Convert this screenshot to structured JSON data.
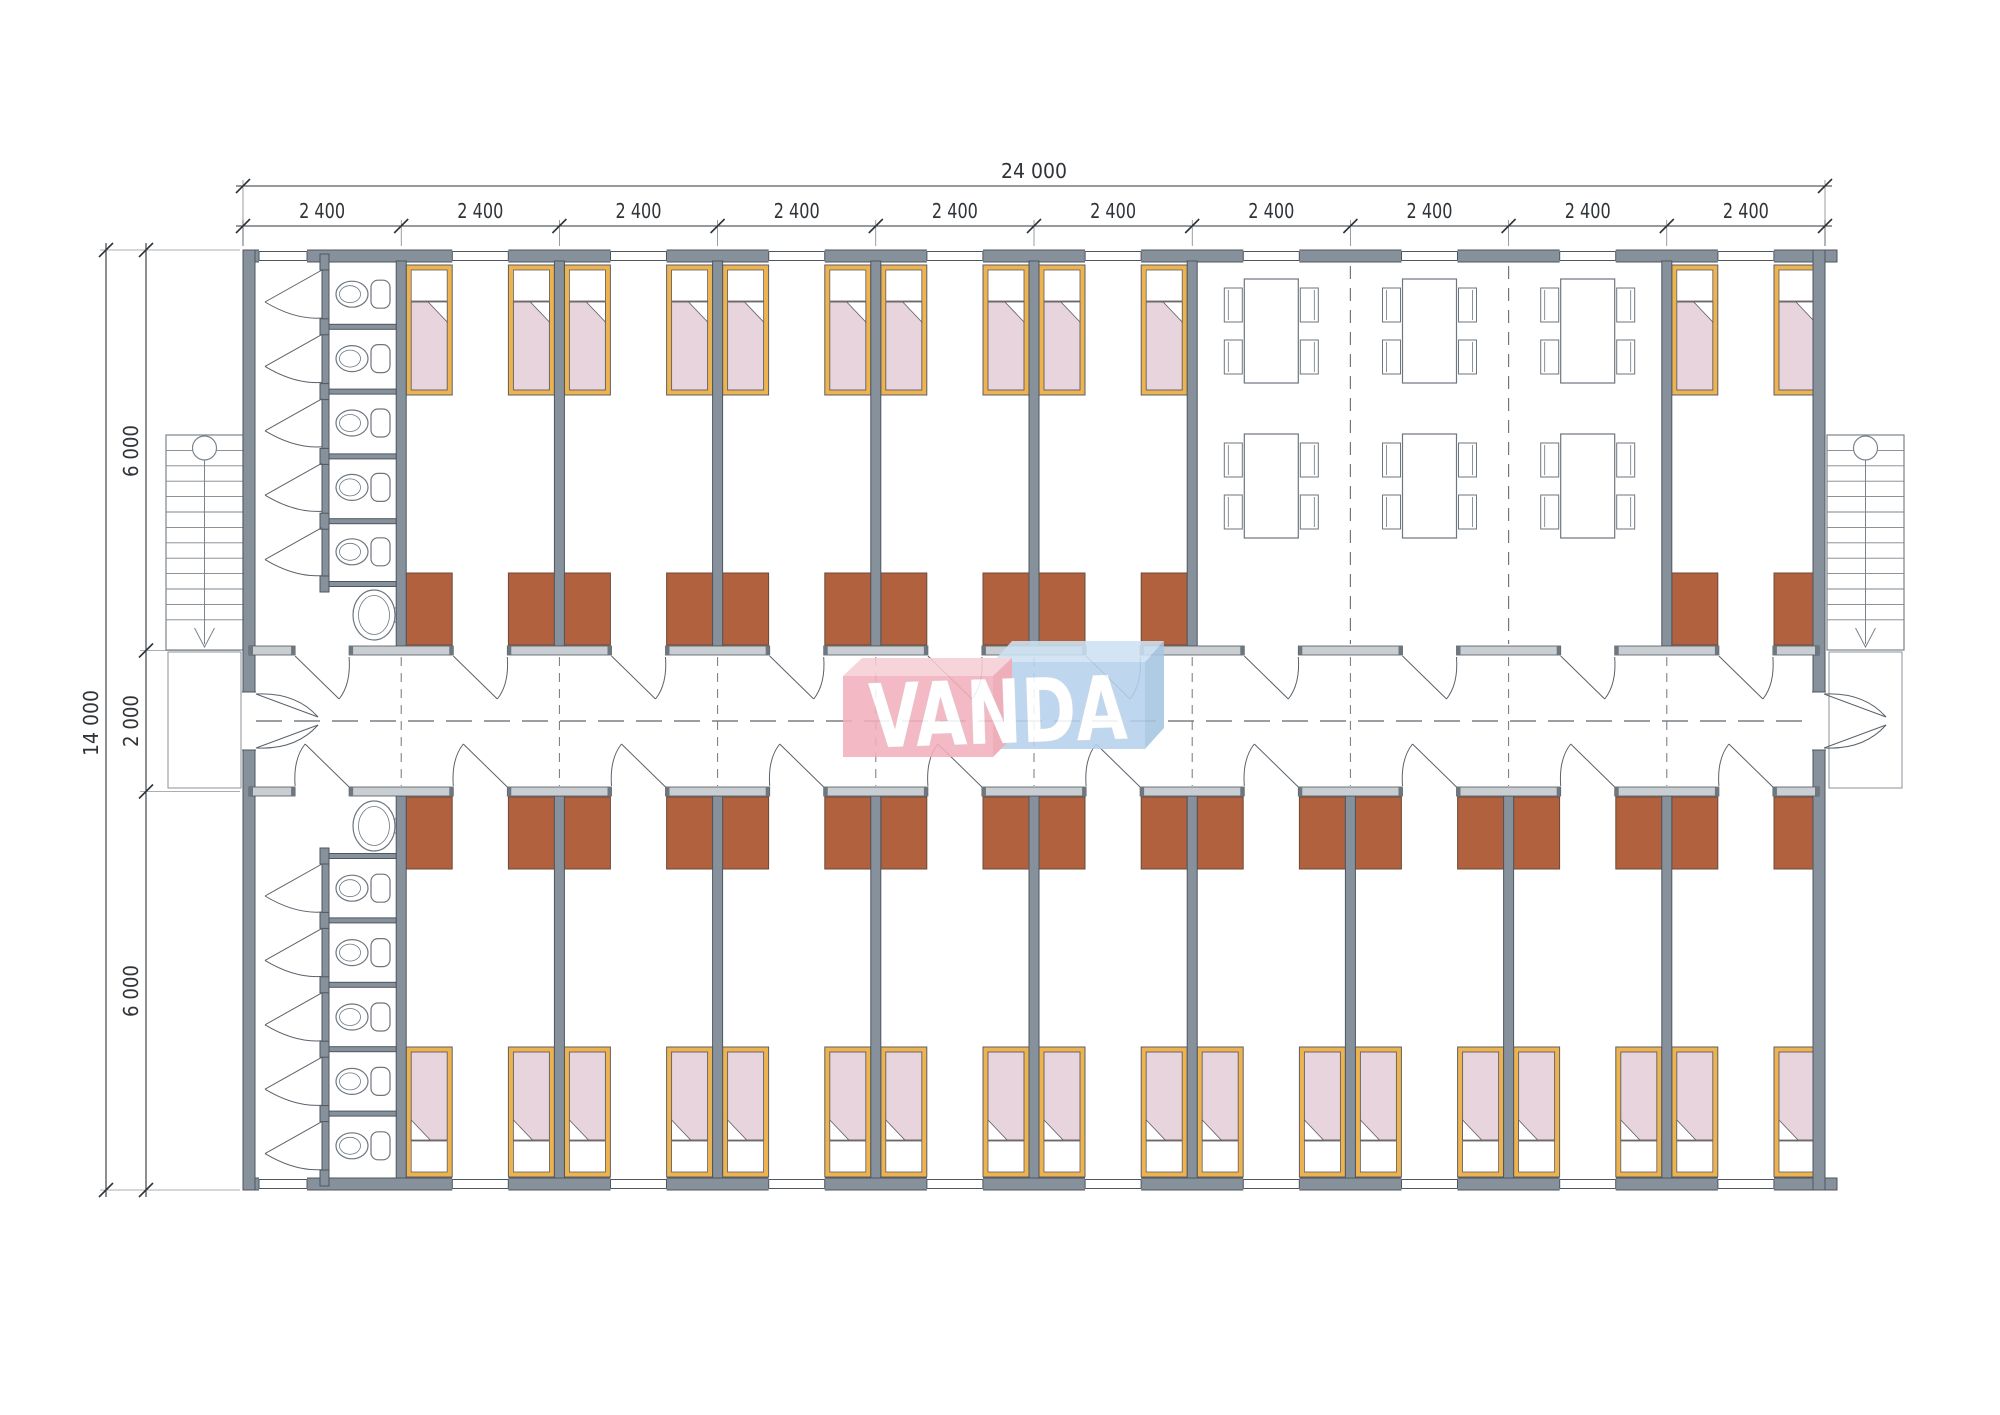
{
  "logo": {
    "text": "VANDA",
    "red": "#F2B0BD",
    "red_top": "#F7CDD6",
    "red_side": "#ECA3B1",
    "blue": "#B7D2EC",
    "blue_top": "#CDE2F3",
    "blue_side": "#A6C6E2",
    "text_color": "#FFFFFF"
  },
  "dimensions": {
    "total_width": "24 000",
    "module_width": "2 400",
    "module_count": 10,
    "total_depth": "14 000",
    "top_room_depth": "6 000",
    "corridor_depth": "2 000",
    "bottom_room_depth": "6 000"
  },
  "colors": {
    "wall": "#87919B",
    "wall_edge": "#4E565F",
    "corridor_wall": "#C9CED3",
    "corridor_wall_cap": "#6E767E",
    "bed_frame": "#EDB34F",
    "bed_outline": "#5E5E68",
    "blanket": "#E7D4DC",
    "pillow": "#FFFFFF",
    "wardrobe": "#B2613E",
    "wardrobe_edge": "#6B4A3A",
    "fixture_line": "#6E767E",
    "stair_line": "#7B848C",
    "dashed_line": "#70787F",
    "dim_line": "#2F3439",
    "background": "#FFFFFF"
  },
  "plan": {
    "modules": 10,
    "wc_blocks": 2,
    "wc_stalls_per_block": 5,
    "sinks": 2,
    "beds_top_row": 12,
    "beds_bottom_row": 18,
    "wardrobes": 30,
    "dining_tables": 6,
    "chairs_per_table": 4,
    "staircases": 2,
    "corridor_double_doors": 2
  }
}
